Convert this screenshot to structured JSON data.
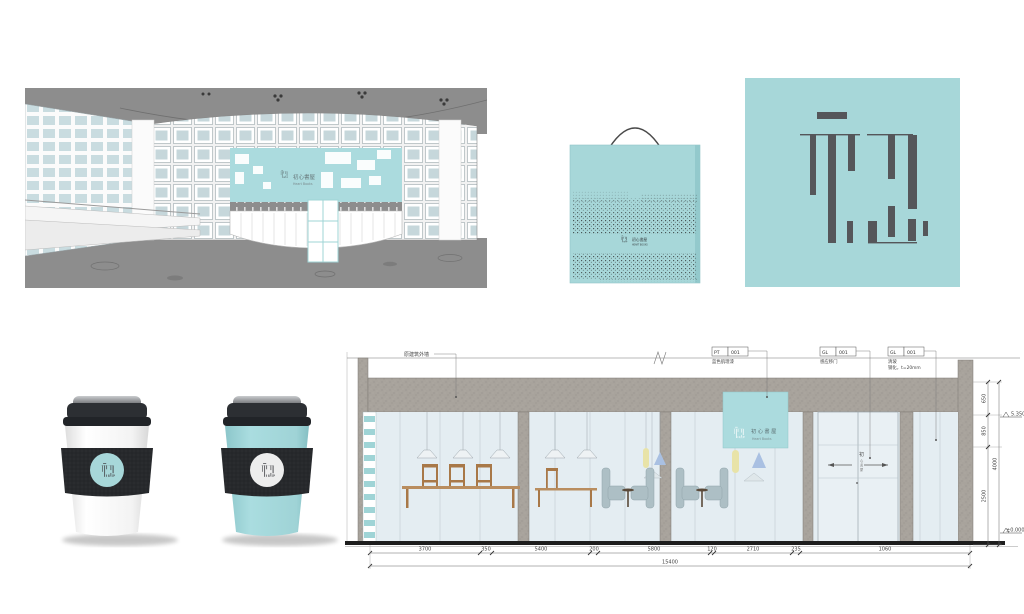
{
  "colors": {
    "teal": "#a7d7d9",
    "teal_sign": "#abdbde",
    "dark": "#55565a",
    "concrete": "#a8a39c",
    "glass": "#e4edf2"
  },
  "render": {
    "sign_cn": "初心書屋",
    "sign_en": "Heart Books"
  },
  "bag": {
    "logo_cn": "初心書屋",
    "logo_en": "HEART BOOKS"
  },
  "elevation": {
    "wall_label": "原建筑外墙",
    "callout_pt_code": "PT",
    "callout_pt_num": "001",
    "callout_pt_desc": "蓝色肌理漆",
    "callout_gl1_code": "GL",
    "callout_gl1_num": "001",
    "callout_gl1_desc": "感应移门",
    "callout_gl2_code": "GL",
    "callout_gl2_num": "001",
    "callout_gl2_desc1": "清玻",
    "callout_gl2_desc2": "钢化，t=20mm",
    "sign_cn": "初心書屋",
    "sign_en": "Heart Books",
    "door_chars": [
      "初",
      "心",
      "書",
      "屋"
    ],
    "dims_bottom": [
      "3700",
      "350",
      "5400",
      "200",
      "5800",
      "120",
      "2710",
      "235",
      "1060"
    ],
    "dim_total": "15400",
    "dims_right": [
      "650",
      "850",
      "2500"
    ],
    "dim_right_total": "4000",
    "level_top": "5.350",
    "level_bottom": "±0.000"
  }
}
